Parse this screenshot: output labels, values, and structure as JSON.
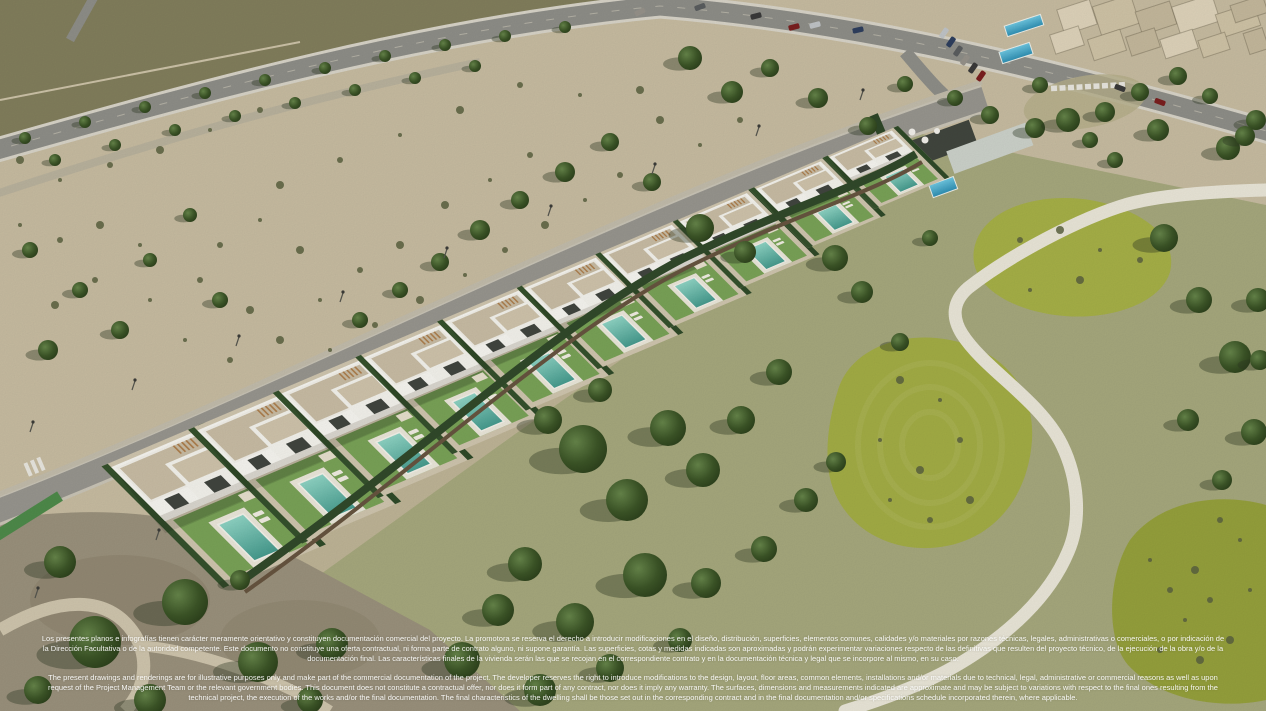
{
  "image": {
    "kind": "aerial-render-photo",
    "subject": "Aerial 3D render of a row of modern white villas with private pools beside a golf course"
  },
  "disclaimer": {
    "spanish": "Los presentes planos e infografías tienen carácter meramente orientativo y constituyen documentación comercial del proyecto. La promotora se reserva el derecho a introducir modificaciones en el diseño, distribución, superficies, elementos comunes, calidades y/o materiales por razones técnicas, legales, administrativas o comerciales, o por indicación de la Dirección Facultativa o de la autoridad competente. Este documento no constituye una oferta contractual, ni forma parte de contrato alguno, ni supone garantía. Las superficies, cotas y medidas indicadas son aproximadas y podrán experimentar variaciones respecto de las definitivas que resulten del proyecto técnico, de la ejecución de la obra y/o de la documentación final. Las características finales de la vivienda serán las que se recojan en el correspondiente contrato y en la documentación técnica y legal que se incorpore al mismo, en su caso.",
    "english": "The present drawings and renderings are for illustrative purposes only and make part of the commercial documentation of the project. The developer reserves the right to introduce modifications to the design, layout, floor areas, common elements, installations and/or materials due to technical, legal, administrative or commercial reasons as well as upon request of the Project Management Team or the relevant government bodies. This document does not constitute a contractual offer, nor does it form part of any contract, nor does it imply any warranty. The surfaces, dimensions and measurements indicated are approximate and may be subject to variations with respect to the final ones resulting from the technical project, the execution of the works and/or the final documentation. The final characteristics of the dwelling shall be those set out in the corresponding contract and in the final documentation and/or specifications schedule incorporated therein, where applicable."
  },
  "palette": {
    "scrub": "#c7bca1",
    "dark_hill": "#827e5c",
    "dirt": "#9a917c",
    "golf_rough": "#a6a87d",
    "golf_green": "#a6b047",
    "cart_path": "#eae6d8",
    "road": "#8e8e88",
    "street": "#97958e",
    "villa_white": "#f6f5f0",
    "roof_gravel": "#c8bca4",
    "lawn": "#79a257",
    "pool": "#58b2a4",
    "hedge": "#35512c",
    "wall": "#66543f",
    "tree": "#3c5527",
    "bush": "#5a6140",
    "apartment": "#d8cdb4",
    "blue_pool": "#3fa9c9",
    "text": "#ffffff",
    "car_colors": [
      "#3a3a3a",
      "#7a1f1f",
      "#c0c4c7",
      "#2e3f5e",
      "#5a5d5f",
      "#96928a"
    ]
  },
  "scene": {
    "villas": [
      [
        99,
        455,
        1.14,
        1.0
      ],
      [
        186,
        419,
        1.1,
        0.97
      ],
      [
        271,
        383,
        1.06,
        0.93
      ],
      [
        354,
        348,
        1.02,
        0.89
      ],
      [
        436,
        313,
        0.98,
        0.85
      ],
      [
        516,
        280,
        0.95,
        0.8
      ],
      [
        595,
        247,
        0.92,
        0.75
      ],
      [
        673,
        215,
        0.89,
        0.7
      ],
      [
        750,
        183,
        0.86,
        0.64
      ],
      [
        824,
        152,
        0.83,
        0.58
      ]
    ],
    "trees": [
      [
        583,
        449,
        24
      ],
      [
        627,
        500,
        21
      ],
      [
        668,
        428,
        18
      ],
      [
        703,
        470,
        17
      ],
      [
        741,
        420,
        14
      ],
      [
        779,
        372,
        13
      ],
      [
        645,
        575,
        22
      ],
      [
        575,
        622,
        19
      ],
      [
        525,
        564,
        17
      ],
      [
        706,
        583,
        15
      ],
      [
        764,
        549,
        13
      ],
      [
        806,
        500,
        12
      ],
      [
        836,
        462,
        10
      ],
      [
        600,
        390,
        12
      ],
      [
        548,
        420,
        14
      ],
      [
        498,
        610,
        16
      ],
      [
        462,
        660,
        18
      ],
      [
        540,
        690,
        16
      ],
      [
        610,
        668,
        14
      ],
      [
        680,
        640,
        12
      ],
      [
        835,
        258,
        13
      ],
      [
        862,
        292,
        11
      ],
      [
        900,
        342,
        9
      ],
      [
        930,
        238,
        8
      ],
      [
        1164,
        238,
        14
      ],
      [
        1199,
        300,
        13
      ],
      [
        1235,
        357,
        16
      ],
      [
        1188,
        420,
        11
      ],
      [
        1254,
        432,
        13
      ],
      [
        1222,
        480,
        10
      ],
      [
        1158,
        130,
        11
      ],
      [
        1228,
        148,
        12
      ],
      [
        1256,
        120,
        10
      ],
      [
        1115,
        160,
        8
      ],
      [
        1258,
        300,
        12
      ],
      [
        1260,
        360,
        10
      ],
      [
        95,
        642,
        26
      ],
      [
        185,
        602,
        23
      ],
      [
        258,
        662,
        20
      ],
      [
        60,
        562,
        16
      ],
      [
        332,
        644,
        16
      ],
      [
        38,
        690,
        14
      ],
      [
        150,
        700,
        16
      ],
      [
        240,
        580,
        10
      ],
      [
        310,
        700,
        13
      ],
      [
        120,
        330,
        9
      ],
      [
        80,
        290,
        8
      ],
      [
        48,
        350,
        10
      ],
      [
        150,
        260,
        7
      ],
      [
        220,
        300,
        8
      ],
      [
        30,
        250,
        8
      ],
      [
        190,
        215,
        7
      ],
      [
        690,
        58,
        12
      ],
      [
        732,
        92,
        11
      ],
      [
        770,
        68,
        9
      ],
      [
        818,
        98,
        10
      ],
      [
        868,
        126,
        9
      ],
      [
        905,
        84,
        8
      ],
      [
        700,
        228,
        14
      ],
      [
        745,
        252,
        11
      ],
      [
        652,
        182,
        9
      ],
      [
        610,
        142,
        9
      ],
      [
        565,
        172,
        10
      ],
      [
        520,
        200,
        9
      ],
      [
        480,
        230,
        10
      ],
      [
        440,
        262,
        9
      ],
      [
        400,
        290,
        8
      ],
      [
        360,
        320,
        8
      ],
      [
        25,
        138,
        6
      ],
      [
        85,
        122,
        6
      ],
      [
        145,
        107,
        6
      ],
      [
        205,
        93,
        6
      ],
      [
        265,
        80,
        6
      ],
      [
        325,
        68,
        6
      ],
      [
        385,
        56,
        6
      ],
      [
        445,
        45,
        6
      ],
      [
        505,
        36,
        6
      ],
      [
        565,
        27,
        6
      ],
      [
        55,
        160,
        6
      ],
      [
        115,
        145,
        6
      ],
      [
        175,
        130,
        6
      ],
      [
        235,
        116,
        6
      ],
      [
        295,
        103,
        6
      ],
      [
        355,
        90,
        6
      ],
      [
        415,
        78,
        6
      ],
      [
        475,
        66,
        6
      ],
      [
        1035,
        128,
        10
      ],
      [
        1068,
        120,
        12
      ],
      [
        1105,
        112,
        10
      ],
      [
        1140,
        92,
        9
      ],
      [
        1040,
        85,
        8
      ],
      [
        990,
        115,
        9
      ],
      [
        955,
        98,
        8
      ],
      [
        1178,
        76,
        9
      ],
      [
        1210,
        96,
        8
      ],
      [
        1245,
        136,
        10
      ],
      [
        1090,
        140,
        8
      ]
    ],
    "bushes": [
      [
        20,
        225
      ],
      [
        60,
        240
      ],
      [
        100,
        225
      ],
      [
        140,
        245
      ],
      [
        95,
        280
      ],
      [
        55,
        305
      ],
      [
        150,
        300
      ],
      [
        200,
        280
      ],
      [
        250,
        310
      ],
      [
        185,
        340
      ],
      [
        230,
        360
      ],
      [
        280,
        340
      ],
      [
        320,
        300
      ],
      [
        360,
        270
      ],
      [
        400,
        245
      ],
      [
        330,
        350
      ],
      [
        375,
        325
      ],
      [
        420,
        300
      ],
      [
        465,
        275
      ],
      [
        505,
        250
      ],
      [
        545,
        225
      ],
      [
        585,
        200
      ],
      [
        620,
        175
      ],
      [
        445,
        205
      ],
      [
        490,
        180
      ],
      [
        530,
        155
      ],
      [
        300,
        250
      ],
      [
        260,
        220
      ],
      [
        220,
        245
      ],
      [
        660,
        120
      ],
      [
        700,
        145
      ],
      [
        740,
        120
      ],
      [
        640,
        90
      ],
      [
        580,
        95
      ],
      [
        520,
        85
      ],
      [
        460,
        110
      ],
      [
        400,
        135
      ],
      [
        340,
        160
      ],
      [
        280,
        185
      ],
      [
        60,
        180
      ],
      [
        110,
        165
      ],
      [
        160,
        150
      ],
      [
        210,
        130
      ],
      [
        260,
        110
      ],
      [
        20,
        160
      ],
      [
        1150,
        560
      ],
      [
        1170,
        590
      ],
      [
        1195,
        570
      ],
      [
        1185,
        620
      ],
      [
        1210,
        600
      ],
      [
        1230,
        640
      ],
      [
        1250,
        590
      ],
      [
        1160,
        650
      ],
      [
        1200,
        660
      ],
      [
        1240,
        540
      ],
      [
        1220,
        520
      ],
      [
        900,
        380
      ],
      [
        940,
        400
      ],
      [
        960,
        440
      ],
      [
        920,
        470
      ],
      [
        880,
        440
      ],
      [
        930,
        520
      ],
      [
        970,
        500
      ],
      [
        890,
        500
      ],
      [
        1020,
        240
      ],
      [
        1060,
        230
      ],
      [
        1100,
        250
      ],
      [
        1140,
        260
      ],
      [
        1080,
        280
      ],
      [
        1030,
        290
      ]
    ],
    "cars": [
      [
        756,
        16,
        -15
      ],
      [
        794,
        27,
        -15
      ],
      [
        815,
        25,
        -15
      ],
      [
        858,
        30,
        -12
      ],
      [
        700,
        7,
        -20
      ],
      [
        640,
        12,
        -25
      ],
      [
        1120,
        88,
        20
      ],
      [
        1160,
        102,
        20
      ],
      [
        944,
        33,
        -55
      ],
      [
        951,
        42,
        -55
      ],
      [
        958,
        51,
        -55
      ],
      [
        965,
        60,
        -55
      ],
      [
        973,
        68,
        -55
      ],
      [
        981,
        76,
        -55
      ]
    ],
    "apartments": [
      [
        1060,
        4,
        34,
        26
      ],
      [
        1096,
        0,
        40,
        30
      ],
      [
        1138,
        6,
        36,
        24
      ],
      [
        1175,
        0,
        42,
        28
      ],
      [
        1218,
        8,
        40,
        24
      ],
      [
        1246,
        30,
        20,
        22
      ],
      [
        1052,
        30,
        30,
        20
      ],
      [
        1090,
        34,
        34,
        22
      ],
      [
        1128,
        32,
        30,
        20
      ],
      [
        1162,
        34,
        34,
        20
      ],
      [
        1200,
        36,
        28,
        18
      ],
      [
        1232,
        0,
        34,
        18
      ]
    ],
    "blue_pools": [
      [
        1005,
        20,
        38,
        11
      ],
      [
        1000,
        47,
        32,
        12
      ]
    ],
    "sign_blocks": 9,
    "lamps": [
      [
        30,
        432
      ],
      [
        132,
        390
      ],
      [
        236,
        346
      ],
      [
        340,
        302
      ],
      [
        444,
        258
      ],
      [
        548,
        216
      ],
      [
        652,
        174
      ],
      [
        756,
        136
      ],
      [
        860,
        100
      ],
      [
        156,
        540
      ],
      [
        35,
        598
      ]
    ]
  }
}
